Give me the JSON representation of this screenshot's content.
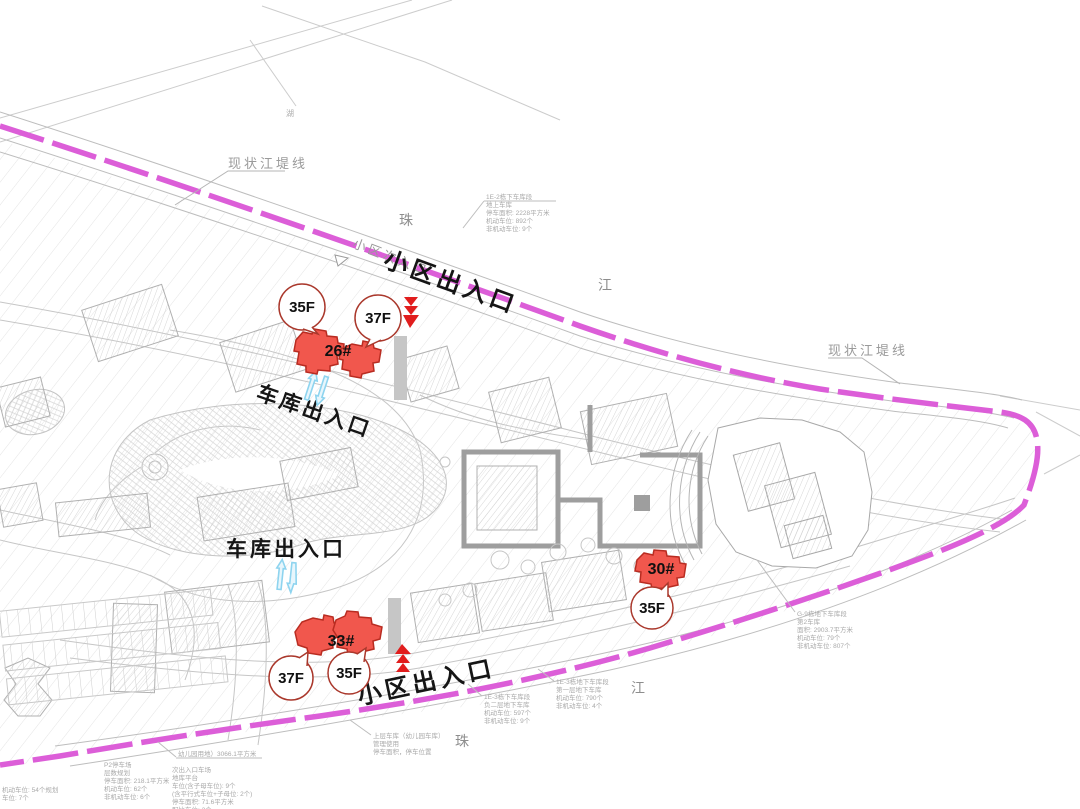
{
  "embankment": {
    "top_left": "现状江堤线",
    "right": "现状江堤线"
  },
  "river": {
    "zhu_top": "珠",
    "jiang_top": "江",
    "zhu_bottom": "珠",
    "jiang_bottom": "江"
  },
  "entrances": {
    "main_top": "小区出入口",
    "main_bottom": "小区出入口",
    "secondary": "小区次入口",
    "garage_top": "车库出入口",
    "garage_bottom": "车库出入口"
  },
  "buildings": {
    "b26": {
      "label": "26#",
      "callout_left": "35F",
      "callout_right": "37F"
    },
    "b33": {
      "label": "33#",
      "callout_left": "37F",
      "callout_right": "35F"
    },
    "b30": {
      "label": "30#",
      "callout": "35F"
    }
  },
  "micro": {
    "lake": "湖"
  },
  "annotations": {
    "t1": {
      "lines": [
        "1E-2栋下车库段",
        "地上车库",
        "停车面积: 2228平方米",
        "机动车位: 892个",
        "非机动车位: 9个"
      ]
    },
    "r1": {
      "lines": [
        "G-9栋地下车库段",
        "第2车库",
        "面积: 2903.7平方米",
        "机动车位: 79个",
        "非机动车位: 807个"
      ]
    },
    "b0": {
      "lines": [
        "上层车库（幼儿园车库）",
        "管理使用",
        "停车面积，停车位置"
      ]
    },
    "b1": {
      "lines": [
        "1E-3栋地下车库段",
        "第一层地下车库",
        "机动车位: 790个",
        "非机动车位: 4个"
      ]
    },
    "b2": {
      "lines": [
        "1E-3栋下车库段",
        "负二层地下车库",
        "机动车位: 597个",
        "非机动车位: 9个"
      ]
    },
    "bl1": {
      "lines": [
        "幼儿园用地）3066.1平方米"
      ]
    },
    "bl2": {
      "lines": [
        "次出入口车场",
        "地库平台",
        "车位(含子母车位): 9个",
        "(含平行式车位+子母位: 2个)",
        "停车面积: 71.6平方米",
        "配比车位: 2个"
      ]
    },
    "bl3": {
      "lines": [
        "P2停车场",
        "层数规划",
        "停车面积: 218.1平方米",
        "机动车位: 62个",
        "非机动车位: 6个"
      ]
    },
    "ll": {
      "lines": [
        "机动车位: 54个规划",
        "车位: 7个"
      ]
    }
  },
  "colors": {
    "boundary_magenta": "#dc5ed8",
    "building_red_fill": "#f1574d",
    "building_red_stroke": "#b92c21",
    "callout_stroke": "#aa382c",
    "arrow_red": "#e11d1d",
    "arrow_blue": "#8ed4ef",
    "linework_gray": "#c6c6c6",
    "label_gray": "#9a9a9a",
    "text_black": "#151515"
  }
}
